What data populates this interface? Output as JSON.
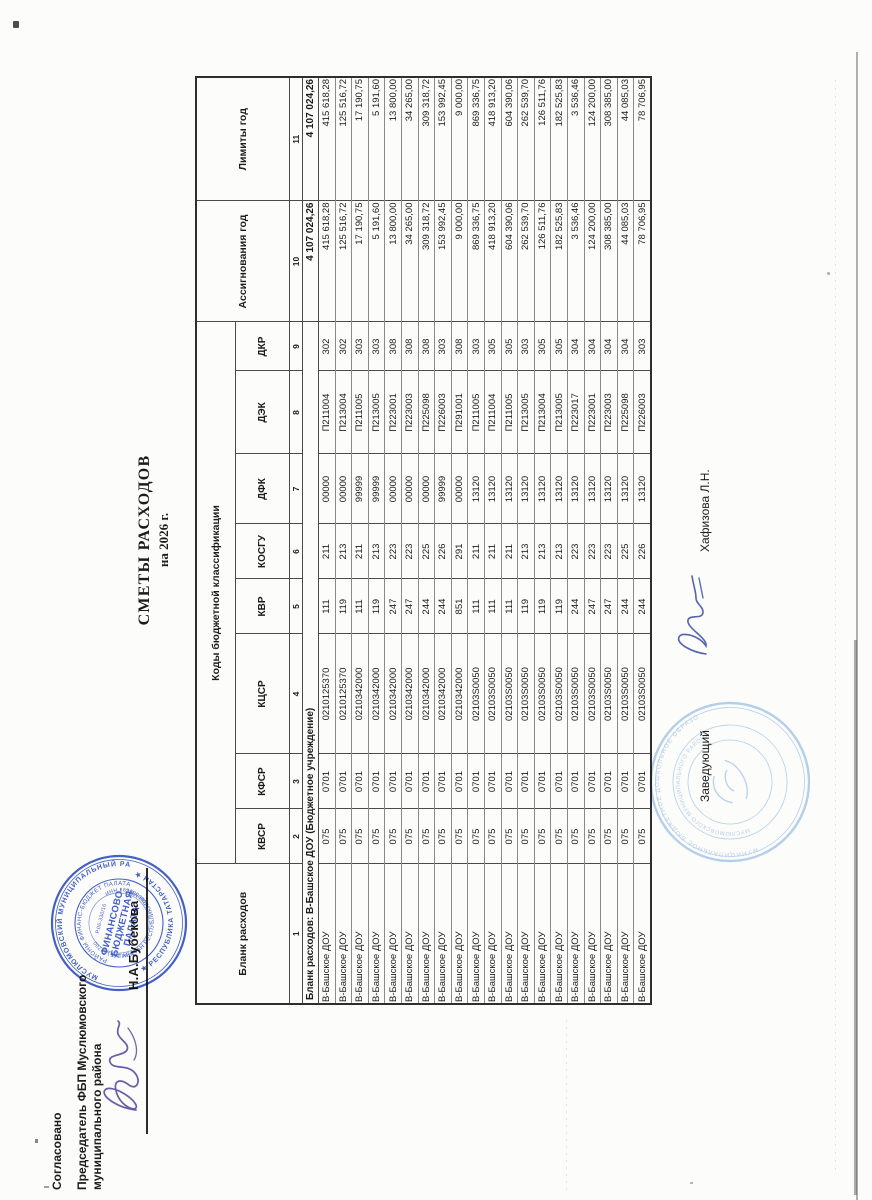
{
  "document": {
    "approval": {
      "line1": "Согласовано",
      "line2": "Председатель ФБП Муслюмовского",
      "line3": "муниципального района",
      "signer": "Н.А.Бубекова"
    },
    "title": {
      "line1": "СМЕТЫ РАСХОДОВ",
      "line2": "на 2026 г."
    },
    "footer": {
      "left_label": "Заведующий",
      "signer": "Хафизова Л.Н."
    }
  },
  "table": {
    "codes_header": "Коды бюджетной классификации",
    "columns": [
      {
        "label": "Бланк расходов",
        "num": "1"
      },
      {
        "label": "КВСР",
        "num": "2"
      },
      {
        "label": "КФСР",
        "num": "3"
      },
      {
        "label": "КЦСР",
        "num": "4"
      },
      {
        "label": "КВР",
        "num": "5"
      },
      {
        "label": "КОСГУ",
        "num": "6"
      },
      {
        "label": "ДФК",
        "num": "7"
      },
      {
        "label": "ДЭК",
        "num": "8"
      },
      {
        "label": "ДКР",
        "num": "9"
      },
      {
        "label": "Ассигнования год",
        "num": "10"
      },
      {
        "label": "Лимиты год",
        "num": "11"
      }
    ],
    "group": {
      "label": "Бланк расходов: В-Башское ДОУ (Бюджетное учреждение)",
      "total_assign": "4 107 024,26",
      "total_limit": "4 107 024,26"
    },
    "rows": [
      [
        "В-Башское ДОУ",
        "075",
        "0701",
        "0210125370",
        "111",
        "211",
        "00000",
        "П211004",
        "302",
        "415 618,28",
        "415 618,28"
      ],
      [
        "В-Башское ДОУ",
        "075",
        "0701",
        "0210125370",
        "119",
        "213",
        "00000",
        "П213004",
        "302",
        "125 516,72",
        "125 516,72"
      ],
      [
        "В-Башское ДОУ",
        "075",
        "0701",
        "0210342000",
        "111",
        "211",
        "99999",
        "П211005",
        "303",
        "17 190,75",
        "17 190,75"
      ],
      [
        "В-Башское ДОУ",
        "075",
        "0701",
        "0210342000",
        "119",
        "213",
        "99999",
        "П213005",
        "303",
        "5 191,60",
        "5 191,60"
      ],
      [
        "В-Башское ДОУ",
        "075",
        "0701",
        "0210342000",
        "247",
        "223",
        "00000",
        "П223001",
        "308",
        "13 800,00",
        "13 800,00"
      ],
      [
        "В-Башское ДОУ",
        "075",
        "0701",
        "0210342000",
        "247",
        "223",
        "00000",
        "П223003",
        "308",
        "34 265,00",
        "34 265,00"
      ],
      [
        "В-Башское ДОУ",
        "075",
        "0701",
        "0210342000",
        "244",
        "225",
        "00000",
        "П225098",
        "308",
        "309 318,72",
        "309 318,72"
      ],
      [
        "В-Башское ДОУ",
        "075",
        "0701",
        "0210342000",
        "244",
        "226",
        "99999",
        "П226003",
        "303",
        "153 992,45",
        "153 992,45"
      ],
      [
        "В-Башское ДОУ",
        "075",
        "0701",
        "0210342000",
        "851",
        "291",
        "00000",
        "П291001",
        "308",
        "9 000,00",
        "9 000,00"
      ],
      [
        "В-Башское ДОУ",
        "075",
        "0701",
        "02103S0050",
        "111",
        "211",
        "13120",
        "П211005",
        "303",
        "869 336,75",
        "869 336,75"
      ],
      [
        "В-Башское ДОУ",
        "075",
        "0701",
        "02103S0050",
        "111",
        "211",
        "13120",
        "П211004",
        "305",
        "418 913,20",
        "418 913,20"
      ],
      [
        "В-Башское ДОУ",
        "075",
        "0701",
        "02103S0050",
        "111",
        "211",
        "13120",
        "П211005",
        "305",
        "604 390,06",
        "604 390,06"
      ],
      [
        "В-Башское ДОУ",
        "075",
        "0701",
        "02103S0050",
        "119",
        "213",
        "13120",
        "П213005",
        "303",
        "262 539,70",
        "262 539,70"
      ],
      [
        "В-Башское ДОУ",
        "075",
        "0701",
        "02103S0050",
        "119",
        "213",
        "13120",
        "П213004",
        "305",
        "126 511,76",
        "126 511,76"
      ],
      [
        "В-Башское ДОУ",
        "075",
        "0701",
        "02103S0050",
        "119",
        "213",
        "13120",
        "П213005",
        "305",
        "182 525,83",
        "182 525,83"
      ],
      [
        "В-Башское ДОУ",
        "075",
        "0701",
        "02103S0050",
        "244",
        "223",
        "13120",
        "П223017",
        "304",
        "3 536,46",
        "3 536,46"
      ],
      [
        "В-Башское ДОУ",
        "075",
        "0701",
        "02103S0050",
        "247",
        "223",
        "13120",
        "П223001",
        "304",
        "124 200,00",
        "124 200,00"
      ],
      [
        "В-Башское ДОУ",
        "075",
        "0701",
        "02103S0050",
        "247",
        "223",
        "13120",
        "П223003",
        "304",
        "308 385,00",
        "308 385,00"
      ],
      [
        "В-Башское ДОУ",
        "075",
        "0701",
        "02103S0050",
        "244",
        "225",
        "13120",
        "П225098",
        "304",
        "44 085,03",
        "44 085,03"
      ],
      [
        "В-Башское ДОУ",
        "075",
        "0701",
        "02103S0050",
        "244",
        "226",
        "13120",
        "П226003",
        "303",
        "78 706,95",
        "78 706,95"
      ]
    ]
  },
  "stamps": {
    "fbp": {
      "outer_top": "МУСЛЮМОВСКИЙ МУНИЦИПАЛЬНЫЙ РАЙОН",
      "outer_bottom": "★ РЕСПУБЛИКА ТАТАРСТАН ★",
      "inner_top": "РАЙОНЫ ФИНАНС-БЮДЖЕТ ПАЛАТАСЫ",
      "inner_bottom": "ТАТАРСТАН РЕСПУБЛИКАСЫ МӨСЛИМ МУНИЦИПАЛЬ",
      "ogrn": "ОГРН 1061687000220",
      "reg_no": "Р.06-330/16",
      "inn": "ИНН 1629006890",
      "center_line1": "ФИНАНСОВО-",
      "center_line2": "БЮДЖЕТНАЯ",
      "center_line3": "ПАЛАТА",
      "color": "#2e4fbe"
    },
    "dou": {
      "ring1": "МУНИЦИПАЛЬНОЕ БЮДЖЕТНОЕ ДОШКОЛЬНОЕ ОБРАЗОВАТЕЛЬНОЕ УЧРЕЖДЕНИЕ",
      "ring2": "МУСЛЮМОВСКОГО МУНИЦИПАЛЬНОГО РАЙОНА РЕСПУБЛИКИ ТАТАРСТАН",
      "color": "#a7c7e6"
    }
  },
  "colors": {
    "ink_purple": "#584a9e",
    "ink_blue": "#4053a8",
    "stamp_blue": "#2e4fbe",
    "stamp_faint": "#a7c7e6",
    "table_line": "#4a4a4a"
  }
}
